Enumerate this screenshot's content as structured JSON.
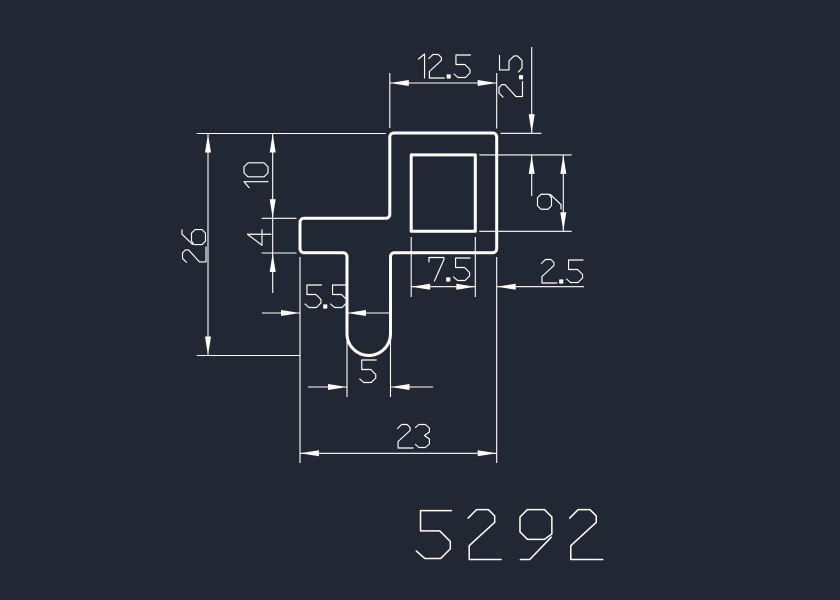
{
  "canvas": {
    "width": 840,
    "height": 600
  },
  "colors": {
    "background": "#212833",
    "line": "#ffffff"
  },
  "part_number": {
    "text": "5292",
    "x": 510,
    "y": 534,
    "cap_height": 51,
    "letter_spacing": 7.4,
    "stroke_width": 1.5
  },
  "profile": {
    "description": "cross-section profile outline",
    "outer_path": "M393.8,133 L492.7,133 A4,4 0 0 1 496.7,137 L496.7,248.7 A4,4 0 0 1 492.7,252.7 L394.5,252.7 A4,4 0 0 0 390.5,256.7 L390.5,333.7 A21.75,21.75 0 0 1 347,333.7 L347,256.7 A4,4 0 0 0 343,252.7 L304,252.7 A4,4 0 0 1 300,248.7 L300,222.3 A4,4 0 0 1 304,218.3 L385.8,218.3 A4,4 0 0 0 389.8,214.3 L389.8,137 A4,4 0 0 1 393.8,133 Z",
    "hole_path": "M411.2,154.9 L475.3,154.9 L475.3,231.3 L411.2,231.3 Z",
    "stroke_width": 3
  },
  "dimension_text": {
    "cap_height": 24,
    "stroke_width": 1.15
  },
  "dimension_line_width": 1.1,
  "arrowhead": {
    "length": 19,
    "half_width": 3
  },
  "dimensions": [
    {
      "label": "26",
      "rotated": true,
      "label_x": 194,
      "label_y": 246,
      "lines": [
        [
          196.7,
          133.5,
          386,
          133.5
        ],
        [
          196.7,
          355.5,
          300,
          355.5
        ],
        [
          208,
          133.5,
          208,
          355.5
        ]
      ],
      "arrows": [
        [
          208,
          133.5,
          -90
        ],
        [
          208,
          355.5,
          90
        ]
      ]
    },
    {
      "label": "10",
      "rotated": true,
      "label_x": 256,
      "label_y": 176,
      "lines": [
        [
          272.7,
          133.5,
          272.7,
          218.3
        ],
        [
          261.7,
          218.3,
          296.5,
          218.3
        ]
      ],
      "arrows": [
        [
          272.7,
          133.5,
          -90
        ],
        [
          272.7,
          218.3,
          90
        ]
      ]
    },
    {
      "label": "4",
      "rotated": true,
      "label_x": 259,
      "label_y": 239,
      "lines": [
        [
          272.7,
          218.3,
          272.7,
          293
        ],
        [
          261.7,
          253,
          296.5,
          253
        ]
      ],
      "arrows": [
        [
          272.7,
          253,
          -90
        ]
      ]
    },
    {
      "label": "12.5",
      "rotated": false,
      "label_x": 443,
      "label_y": 66,
      "lines": [
        [
          389.8,
          73,
          389.8,
          128
        ],
        [
          496.7,
          73,
          496.7,
          128.5
        ],
        [
          389.8,
          83,
          496.7,
          83
        ]
      ],
      "arrows": [
        [
          389.8,
          83,
          180
        ],
        [
          496.7,
          83,
          0
        ]
      ]
    },
    {
      "label": "2.5",
      "rotated": true,
      "label_x": 510.5,
      "label_y": 76.5,
      "lines": [
        [
          500.5,
          133.3,
          541.5,
          133.3
        ],
        [
          531.7,
          47,
          531.7,
          133.3
        ],
        [
          531.7,
          154.9,
          531.7,
          196
        ]
      ],
      "arrows": [
        [
          531.7,
          133.3,
          90
        ],
        [
          531.7,
          154.9,
          -90
        ]
      ]
    },
    {
      "label": "9",
      "rotated": true,
      "label_x": 549,
      "label_y": 202,
      "lines": [
        [
          479.3,
          154.9,
          571.7,
          154.9
        ],
        [
          479.3,
          231.3,
          571.7,
          231.3
        ],
        [
          563.3,
          154.9,
          563.3,
          231.3
        ]
      ],
      "arrows": [
        [
          563.3,
          154.9,
          -90
        ],
        [
          563.3,
          231.3,
          90
        ]
      ]
    },
    {
      "label": "7.5",
      "rotated": false,
      "label_x": 449,
      "label_y": 269,
      "lines": [
        [
          411.2,
          237,
          411.2,
          297
        ],
        [
          475.3,
          237,
          475.3,
          297
        ],
        [
          411.2,
          286.7,
          475.3,
          286.7
        ]
      ],
      "arrows": [
        [
          411.2,
          286.7,
          180
        ],
        [
          475.3,
          286.7,
          0
        ]
      ]
    },
    {
      "label": "2.5",
      "rotated": false,
      "label_x": 562,
      "label_y": 271,
      "lines": [
        [
          496.7,
          286.7,
          584,
          286.7
        ]
      ],
      "arrows": [
        [
          496.7,
          286.7,
          180
        ]
      ]
    },
    {
      "label": "5.5",
      "rotated": false,
      "label_x": 326,
      "label_y": 296,
      "lines": [
        [
          262,
          313,
          300,
          313
        ],
        [
          347,
          313,
          389,
          313
        ]
      ],
      "arrows": [
        [
          300,
          313,
          0
        ],
        [
          347,
          313,
          180
        ]
      ]
    },
    {
      "label": "5",
      "rotated": false,
      "label_x": 368,
      "label_y": 371,
      "lines": [
        [
          347,
          340,
          347,
          397
        ],
        [
          390.5,
          340,
          390.5,
          397
        ],
        [
          308,
          387,
          347,
          387
        ],
        [
          390.5,
          387,
          433,
          387
        ]
      ],
      "arrows": [
        [
          347,
          387,
          0
        ],
        [
          390.5,
          387,
          180
        ]
      ]
    },
    {
      "label": "23",
      "rotated": false,
      "label_x": 414,
      "label_y": 436,
      "lines": [
        [
          300,
          257,
          300,
          463
        ],
        [
          496.7,
          257,
          496.7,
          463
        ],
        [
          300,
          453.3,
          496.7,
          453.3
        ]
      ],
      "arrows": [
        [
          300,
          453.3,
          180
        ],
        [
          496.7,
          453.3,
          0
        ]
      ]
    }
  ]
}
